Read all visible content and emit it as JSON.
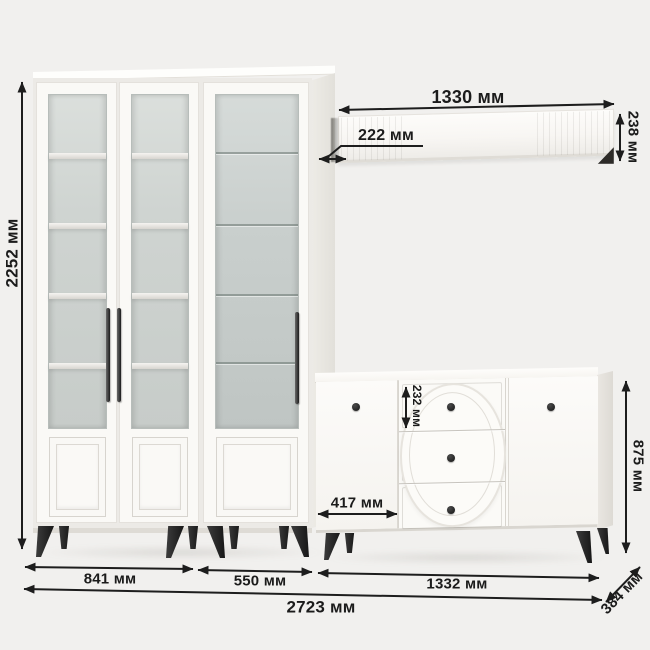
{
  "dims": {
    "cabinet_height": "2252 мм",
    "shelf_width": "1330 мм",
    "shelf_wall_offset": "222 мм",
    "shelf_height": "238 мм",
    "top_drawer_height": "232 мм",
    "commode_left_offset": "417 мм",
    "commode_height": "875 мм",
    "cabinet_left_section_width": "841 мм",
    "cabinet_right_section_width": "550 мм",
    "commode_width": "1332 мм",
    "total_width": "2723 мм",
    "commode_depth": "384 мм"
  },
  "colors": {
    "background": "#f1f0ee",
    "furniture_white": "#faf9f6",
    "glass": "#cdd2cf",
    "legs_and_knobs": "#242424",
    "dimension_ink": "#1b1b1b"
  }
}
